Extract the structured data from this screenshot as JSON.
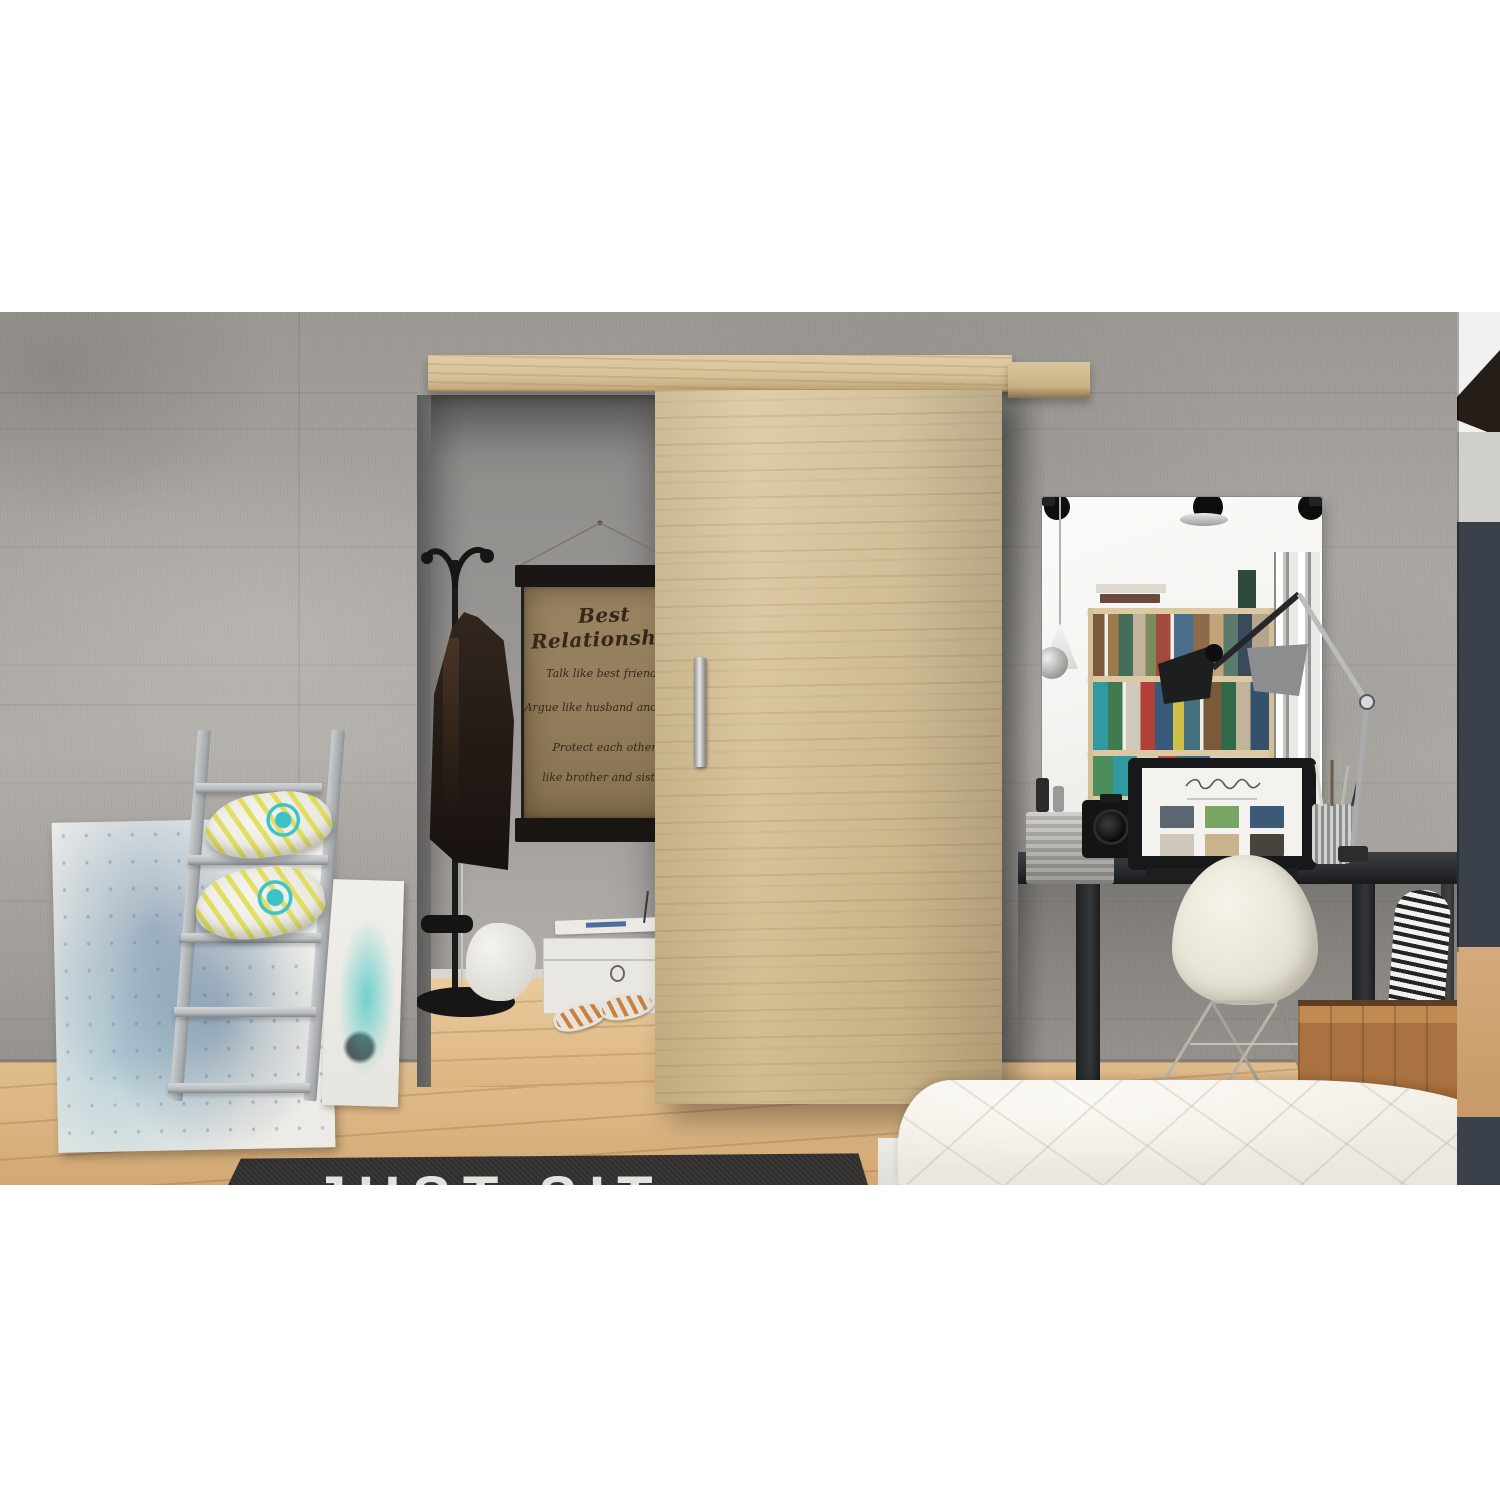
{
  "photo": {
    "poster": {
      "title": "Best Relationship",
      "lines": [
        "Talk like best friends",
        "Argue like husband and wife",
        "Protect each other",
        "like brother and sister"
      ]
    },
    "rug": {
      "text": "JUST SIT"
    },
    "palette": {
      "concrete_wall": "#a8a5a0",
      "oak_door": "#d6c096",
      "wood_floor": "#ddb684",
      "closet_wall": "#9b9996",
      "rug_black": "#2f2e2c",
      "ladder_gray": "#bcc0c2",
      "pillow_teal": "#3cc3ca",
      "pillow_yellow": "#dedc4a",
      "canvas_blue": "#4a7aa0",
      "desk_black": "#2b2e30",
      "chair_white": "#ece8dc",
      "crate_brown": "#aa7240",
      "bed_white": "#f3f0e9",
      "hall_wall_navy": "#3a414b",
      "mirror_white": "#f5f4f1"
    }
  }
}
